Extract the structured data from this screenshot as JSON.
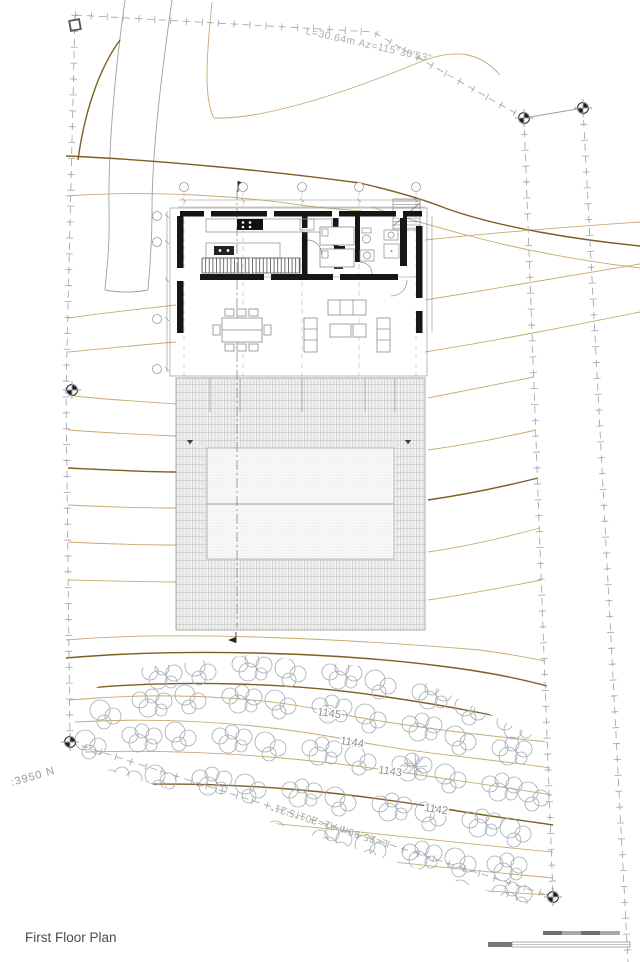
{
  "sheet": {
    "title": "First Floor Plan"
  },
  "survey": {
    "top_edge_label": "L=30.64m  Az=115°30'53\"",
    "bottom_edge_label": "L=25.96m  Az=201°5'21\"",
    "datum_label": ":3950 N"
  },
  "contour_labels": {
    "c1145": "1145",
    "c1144": "1144",
    "c1143": "1143",
    "c1142": "1142"
  },
  "colors": {
    "contour_major": "#7d5e20",
    "contour_minor": "#c8a96f",
    "wall": "#161616",
    "boundary": "#9aa0a8",
    "veg": "#a4aab2",
    "road": "#9aa0a6"
  }
}
